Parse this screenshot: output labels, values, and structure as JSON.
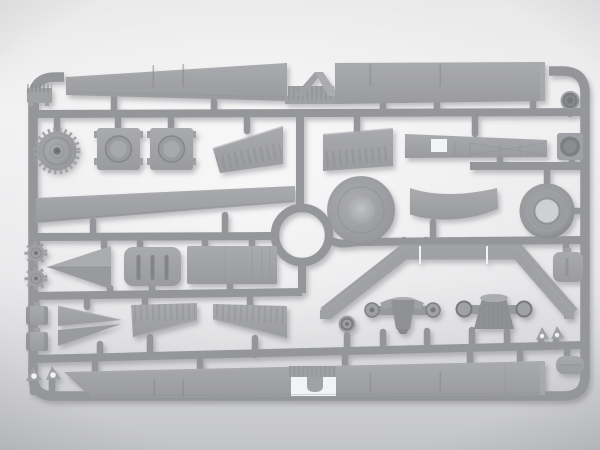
{
  "scene": {
    "subject": "Photograph of a gray injection-molded plastic model kit sprue with unassembled truck parts on a light studio backdrop",
    "plastic_finish": "matte gray styrene",
    "part_count": 35
  },
  "colors": {
    "bg_top": "#e9e9ea",
    "bg_mid": "#f2f2f3",
    "bg_bottom": "#c3c4c7",
    "plastic": "#a0a1a4",
    "plastic_light": "#abacaf",
    "plastic_dark": "#88898d",
    "plastic_deep": "#77787c",
    "runner": "#94969a",
    "hole": "#f2f3f4",
    "shadow": "#6e7076"
  },
  "sprue": {
    "frame": "rounded rectangle runner frame",
    "junction": "circular ring runner junction left of center",
    "frame_label": "sprue runner frame",
    "ring_label": "circular runner junction"
  },
  "parts": [
    {
      "id": 1,
      "label": "top bed side panel left"
    },
    {
      "id": 2,
      "label": "ladder brace between top panels"
    },
    {
      "id": 3,
      "label": "top bed side panel right"
    },
    {
      "id": 4,
      "label": "ribbed bracket"
    },
    {
      "id": 5,
      "label": "toothed drive sprocket wheel"
    },
    {
      "id": 6,
      "label": "axle hub box 1"
    },
    {
      "id": 7,
      "label": "axle hub box 2"
    },
    {
      "id": 8,
      "label": "ribbed wedge panel 1"
    },
    {
      "id": 9,
      "label": "ribbed wedge panel 2"
    },
    {
      "id": 10,
      "label": "chassis frame rail with cutout"
    },
    {
      "id": 11,
      "label": "small idler wheel"
    },
    {
      "id": 12,
      "label": "hub cap box"
    },
    {
      "id": 13,
      "label": "long running board plank"
    },
    {
      "id": 14,
      "label": "solid wheel disc"
    },
    {
      "id": 15,
      "label": "curved cab roof panel"
    },
    {
      "id": 16,
      "label": "road wheel tire"
    },
    {
      "id": 17,
      "label": "small gear hub 1"
    },
    {
      "id": 18,
      "label": "small gear hub 2"
    },
    {
      "id": 19,
      "label": "pointed fairing halves"
    },
    {
      "id": 20,
      "label": "slotted hatch panel"
    },
    {
      "id": 21,
      "label": "flat floor panel"
    },
    {
      "id": 22,
      "label": "ribbed hood half left"
    },
    {
      "id": 23,
      "label": "ribbed hood half right"
    },
    {
      "id": 24,
      "label": "pointed spring wedge pair"
    },
    {
      "id": 25,
      "label": "brake drum 1"
    },
    {
      "id": 26,
      "label": "brake drum 2"
    },
    {
      "id": 27,
      "label": "triangle bracket pair left"
    },
    {
      "id": 28,
      "label": "fender arch band"
    },
    {
      "id": 29,
      "label": "front axle differential"
    },
    {
      "id": 30,
      "label": "rear axle differential"
    },
    {
      "id": 31,
      "label": "tow hook disc"
    },
    {
      "id": 32,
      "label": "triangle bracket pair right"
    },
    {
      "id": 33,
      "label": "battery box"
    },
    {
      "id": 34,
      "label": "tool box"
    },
    {
      "id": 35,
      "label": "bottom bed side panel"
    }
  ]
}
